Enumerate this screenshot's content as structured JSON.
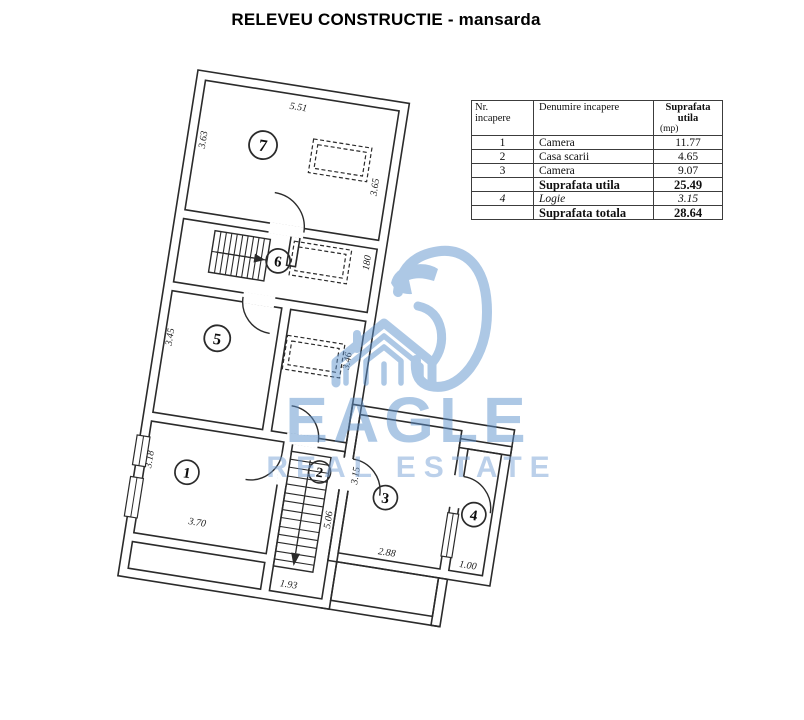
{
  "title": "RELEVEU CONSTRUCTIE - mansarda",
  "table": {
    "header": {
      "col1a": "Nr.",
      "col1b": "incapere",
      "col2": "Denumire incapere",
      "col3a": "Suprafata utila",
      "col3b": "(mp)"
    },
    "rows": [
      {
        "nr": "1",
        "name": "Camera",
        "value": "11.77"
      },
      {
        "nr": "2",
        "name": "Casa scarii",
        "value": "4.65"
      },
      {
        "nr": "3",
        "name": "Camera",
        "value": "9.07"
      },
      {
        "nr": "",
        "name": "Suprafata utila",
        "value": "25.49"
      },
      {
        "nr": "4",
        "name": "Logie",
        "value": "3.15"
      },
      {
        "nr": "",
        "name": "Suprafata totala",
        "value": "28.64"
      }
    ]
  },
  "watermark": {
    "brand": "EAGLE",
    "tagline": "REAL ESTATE",
    "color": "#5e92cc",
    "icon": "eagle-head-house-logo"
  },
  "plan": {
    "line_color": "#2b2b2b",
    "room_labels": {
      "r1": "1",
      "r2": "2",
      "r3": "3",
      "r4": "4",
      "r5": "5",
      "r6": "6",
      "r7": "7"
    },
    "dims": {
      "d551": "5.51",
      "d363": "3.63",
      "d365": "3.65",
      "d180": "180",
      "d345": "3.45",
      "d346": "3.46",
      "d318": "3.18",
      "d370": "3.70",
      "d193": "1.93",
      "d506": "5.06",
      "d315": "3.15",
      "d288": "2.88",
      "d100": "1.00"
    }
  }
}
